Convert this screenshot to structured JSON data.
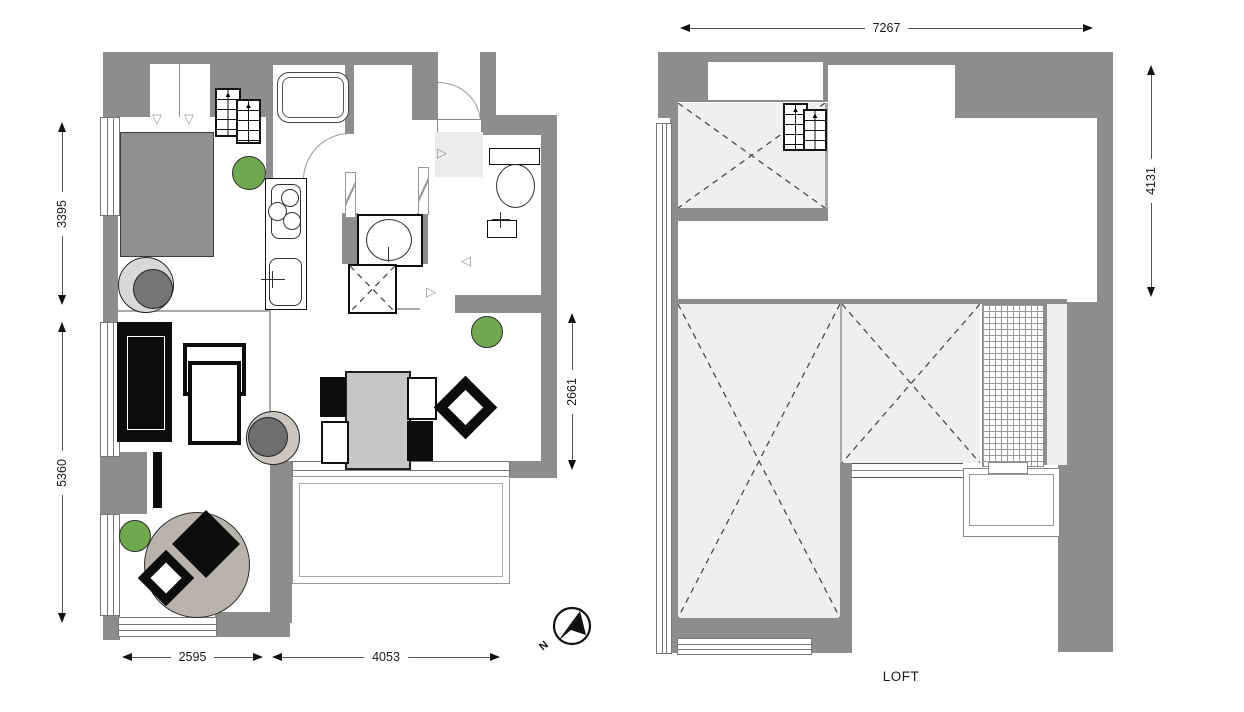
{
  "labels": {
    "loft": "LOFT",
    "north": "N"
  },
  "dims": {
    "main_left_upper": "3395",
    "main_left_lower": "5360",
    "main_bottom_left": "2595",
    "main_bottom_right": "4053",
    "main_right": "2661",
    "loft_top": "7267",
    "loft_right": "4131"
  },
  "colors": {
    "wall_gray": "#8d8d8d",
    "void_fill": "#efefef",
    "plant_green": "#6fa84f",
    "furniture_black": "#0d0d0d",
    "table_gray": "#c6c6c6",
    "rug_gray": "#b7b3af",
    "bed_gray": "#8f8f8f",
    "dim_line": "#555555"
  },
  "icons": {
    "stairs": "stairs-icon",
    "north_compass": "north-compass-icon",
    "plant": "plant-icon",
    "bathtub": "bathtub-icon",
    "toilet": "toilet-icon",
    "stove": "stove-icon",
    "kitchen_sink": "kitchen-sink-icon",
    "washbasin": "washbasin-icon",
    "washing_machine": "washing-machine-icon",
    "closet_door_marker": "closet-door-marker-icon",
    "door_swing_marker": "door-swing-marker-icon"
  }
}
